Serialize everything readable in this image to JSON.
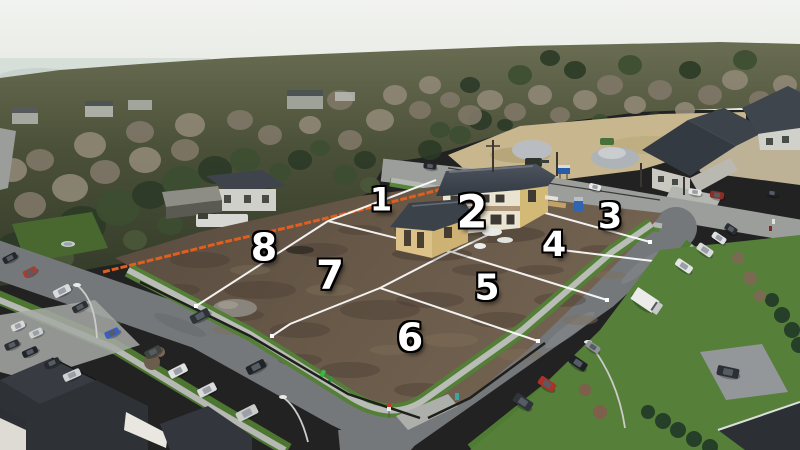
{
  "scene": {
    "kind": "aerial-drone-photo",
    "subject": "vacant development lots with construction house"
  },
  "lot_markers": [
    {
      "label": "1",
      "x": 381,
      "y": 201,
      "size": 32
    },
    {
      "label": "2",
      "x": 472,
      "y": 214,
      "size": 45
    },
    {
      "label": "3",
      "x": 610,
      "y": 219,
      "size": 35
    },
    {
      "label": "4",
      "x": 554,
      "y": 247,
      "size": 35
    },
    {
      "label": "5",
      "x": 487,
      "y": 290,
      "size": 36
    },
    {
      "label": "6",
      "x": 410,
      "y": 339,
      "size": 38
    },
    {
      "label": "7",
      "x": 330,
      "y": 277,
      "size": 40
    },
    {
      "label": "8",
      "x": 264,
      "y": 249,
      "size": 38
    }
  ],
  "palette": {
    "sky": "#edeeec",
    "forest": "#39402c",
    "forest_top": "#5d6148",
    "dirt_a": "#5a4d40",
    "dirt_b": "#6f604d",
    "sand": "#c8b78e",
    "street": "#75787a",
    "street_top": "#9b9e9b",
    "sidewalk": "#b7b9b4",
    "grass": "#538036",
    "roof": "#3c424a",
    "wall_cream": "#eae3d0",
    "wall_tan": "#d3b976",
    "fence_orange": "#e05e1e",
    "line_white": "#ffffff",
    "marker_fill": "#ffffff"
  }
}
